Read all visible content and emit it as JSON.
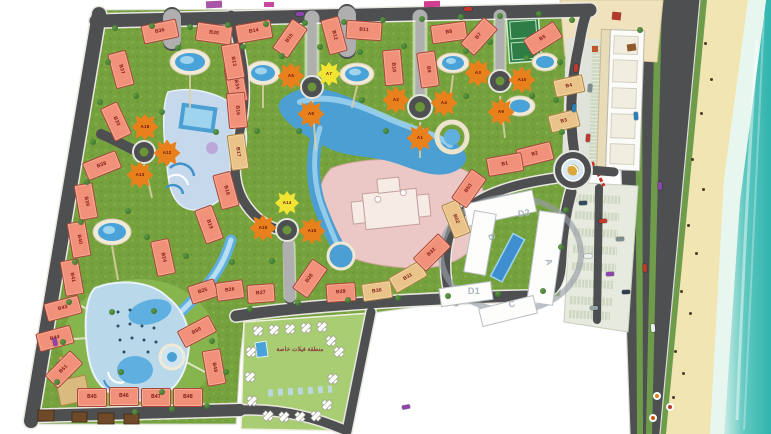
{
  "map": {
    "villas_zone_label": "منطقة فيلات خاصة",
    "colors": {
      "building_salmon": "#f19179",
      "building_tan": "#e9c38a",
      "building_orange": "#e8811c",
      "building_yellow": "#f2e433",
      "road": "#4e4f51",
      "grass": "#76a23e",
      "water": "#4c9fd2",
      "sand": "#f1e5b2",
      "sea": "#2fb3ad",
      "clubhouse_pink": "#ebc7c5"
    },
    "buildings": [
      {
        "l": "B36",
        "x": 160,
        "y": 31,
        "r": -12,
        "t": "b"
      },
      {
        "l": "B35",
        "x": 214,
        "y": 33,
        "r": 8,
        "t": "b"
      },
      {
        "l": "B37",
        "x": 121,
        "y": 69,
        "r": 75,
        "t": "b"
      },
      {
        "l": "B34",
        "x": 236,
        "y": 84,
        "r": 80,
        "t": "b"
      },
      {
        "l": "B33",
        "x": 116,
        "y": 121,
        "r": 65,
        "t": "b"
      },
      {
        "l": "B14",
        "x": 254,
        "y": 31,
        "r": -10,
        "t": "b"
      },
      {
        "l": "B15",
        "x": 290,
        "y": 38,
        "r": -55,
        "t": "b"
      },
      {
        "l": "B13",
        "x": 233,
        "y": 61,
        "r": 80,
        "t": "b"
      },
      {
        "l": "B16",
        "x": 237,
        "y": 110,
        "r": 85,
        "t": "b"
      },
      {
        "l": "B12",
        "x": 334,
        "y": 35,
        "r": 75,
        "t": "b"
      },
      {
        "l": "B11",
        "x": 364,
        "y": 30,
        "r": 4,
        "t": "b"
      },
      {
        "l": "B10",
        "x": 393,
        "y": 67,
        "r": 85,
        "t": "b"
      },
      {
        "l": "B9",
        "x": 428,
        "y": 69,
        "r": 82,
        "t": "b"
      },
      {
        "l": "B8",
        "x": 449,
        "y": 32,
        "r": -8,
        "t": "b"
      },
      {
        "l": "B7",
        "x": 479,
        "y": 36,
        "r": -48,
        "t": "b"
      },
      {
        "l": "B5",
        "x": 543,
        "y": 38,
        "r": -32,
        "t": "b"
      },
      {
        "l": "B4",
        "x": 569,
        "y": 86,
        "r": -12,
        "t": "t",
        "w": 30
      },
      {
        "l": "B3",
        "x": 564,
        "y": 121,
        "r": -14,
        "t": "t",
        "w": 30
      },
      {
        "l": "B2",
        "x": 535,
        "y": 154,
        "r": -14,
        "t": "b"
      },
      {
        "l": "B1",
        "x": 505,
        "y": 164,
        "r": -10,
        "t": "b"
      },
      {
        "l": "B38",
        "x": 102,
        "y": 165,
        "r": -22,
        "t": "b"
      },
      {
        "l": "B39",
        "x": 86,
        "y": 201,
        "r": 80,
        "t": "b"
      },
      {
        "l": "B40",
        "x": 79,
        "y": 239,
        "r": 80,
        "t": "b"
      },
      {
        "l": "B41",
        "x": 72,
        "y": 277,
        "r": 80,
        "t": "b"
      },
      {
        "l": "B43",
        "x": 63,
        "y": 308,
        "r": -15,
        "t": "b"
      },
      {
        "l": "B44",
        "x": 55,
        "y": 338,
        "r": -15,
        "t": "b"
      },
      {
        "l": "B51",
        "x": 64,
        "y": 369,
        "r": -45,
        "t": "b"
      },
      {
        "l": "B45",
        "x": 92,
        "y": 397,
        "r": 0,
        "t": "b",
        "w": 30
      },
      {
        "l": "B46",
        "x": 124,
        "y": 396,
        "r": 0,
        "t": "b",
        "w": 30
      },
      {
        "l": "B47",
        "x": 156,
        "y": 397,
        "r": 0,
        "t": "b",
        "w": 30
      },
      {
        "l": "B48",
        "x": 188,
        "y": 397,
        "r": 0,
        "t": "b",
        "w": 30
      },
      {
        "l": "B49",
        "x": 214,
        "y": 367,
        "r": 80,
        "t": "b"
      },
      {
        "l": "B50",
        "x": 197,
        "y": 331,
        "r": -28,
        "t": "b"
      },
      {
        "l": "B17",
        "x": 238,
        "y": 152,
        "r": 82,
        "t": "t"
      },
      {
        "l": "B18",
        "x": 226,
        "y": 190,
        "r": 75,
        "t": "b"
      },
      {
        "l": "B19",
        "x": 209,
        "y": 224,
        "r": 70,
        "t": "b"
      },
      {
        "l": "B24",
        "x": 163,
        "y": 257,
        "r": 78,
        "t": "b"
      },
      {
        "l": "B25",
        "x": 203,
        "y": 291,
        "r": -18,
        "t": "b",
        "w": 28
      },
      {
        "l": "B26",
        "x": 230,
        "y": 290,
        "r": -8,
        "t": "b",
        "w": 28
      },
      {
        "l": "B27",
        "x": 261,
        "y": 293,
        "r": -4,
        "t": "b",
        "w": 28
      },
      {
        "l": "B28",
        "x": 310,
        "y": 278,
        "r": -55,
        "t": "b"
      },
      {
        "l": "B29",
        "x": 341,
        "y": 292,
        "r": -4,
        "t": "b",
        "w": 30
      },
      {
        "l": "B30",
        "x": 377,
        "y": 291,
        "r": -8,
        "t": "t",
        "w": 30
      },
      {
        "l": "B31",
        "x": 408,
        "y": 277,
        "r": -30,
        "t": "t"
      },
      {
        "l": "B32",
        "x": 432,
        "y": 252,
        "r": -45,
        "t": "b"
      },
      {
        "l": "B52",
        "x": 456,
        "y": 219,
        "r": 68,
        "t": "t"
      },
      {
        "l": "B53",
        "x": 469,
        "y": 188,
        "r": -55,
        "t": "b"
      },
      {
        "l": "A5",
        "x": 291,
        "y": 76,
        "r": 0,
        "t": "a"
      },
      {
        "l": "A8",
        "x": 311,
        "y": 114,
        "r": 0,
        "t": "a"
      },
      {
        "l": "A7",
        "x": 329,
        "y": 74,
        "r": 0,
        "t": "y"
      },
      {
        "l": "A2",
        "x": 396,
        "y": 100,
        "r": 0,
        "t": "a"
      },
      {
        "l": "A4",
        "x": 444,
        "y": 103,
        "r": 0,
        "t": "a"
      },
      {
        "l": "A1",
        "x": 420,
        "y": 138,
        "r": 0,
        "t": "a"
      },
      {
        "l": "A3",
        "x": 478,
        "y": 73,
        "r": 0,
        "t": "a"
      },
      {
        "l": "A10",
        "x": 522,
        "y": 80,
        "r": 0,
        "t": "a"
      },
      {
        "l": "A9",
        "x": 501,
        "y": 112,
        "r": 0,
        "t": "a"
      },
      {
        "l": "A18",
        "x": 145,
        "y": 127,
        "r": 0,
        "t": "a"
      },
      {
        "l": "A12",
        "x": 167,
        "y": 153,
        "r": 0,
        "t": "a"
      },
      {
        "l": "A13",
        "x": 140,
        "y": 175,
        "r": 0,
        "t": "a"
      },
      {
        "l": "A16",
        "x": 263,
        "y": 228,
        "r": 0,
        "t": "a"
      },
      {
        "l": "A15",
        "x": 312,
        "y": 231,
        "r": 0,
        "t": "a"
      },
      {
        "l": "A14",
        "x": 287,
        "y": 203,
        "r": 0,
        "t": "y"
      },
      {
        "l": "D2",
        "x": 524,
        "y": 213,
        "r": -10,
        "t": "w"
      },
      {
        "l": "B",
        "x": 492,
        "y": 237,
        "r": 70,
        "t": "w"
      },
      {
        "l": "A",
        "x": 549,
        "y": 262,
        "r": 75,
        "t": "w"
      },
      {
        "l": "D1",
        "x": 474,
        "y": 291,
        "r": 0,
        "t": "w"
      },
      {
        "l": "C",
        "x": 512,
        "y": 304,
        "r": -12,
        "t": "w"
      }
    ],
    "villas": [
      [
        258,
        331
      ],
      [
        274,
        330
      ],
      [
        290,
        329
      ],
      [
        306,
        328
      ],
      [
        322,
        327
      ],
      [
        339,
        352
      ],
      [
        333,
        379
      ],
      [
        327,
        405
      ],
      [
        251,
        352
      ],
      [
        250,
        377
      ],
      [
        252,
        401
      ],
      [
        268,
        416
      ],
      [
        284,
        417
      ],
      [
        300,
        417
      ],
      [
        316,
        416
      ],
      [
        331,
        341
      ]
    ]
  }
}
